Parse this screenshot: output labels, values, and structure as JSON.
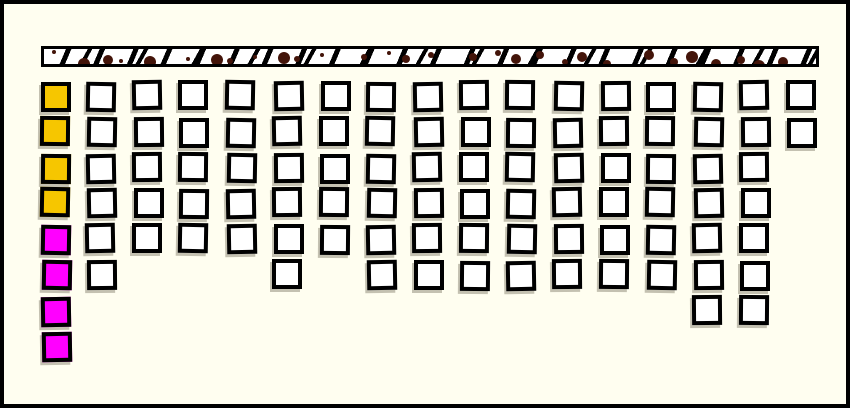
{
  "window": {
    "background_color": "#fffef0",
    "frame_color": "#000000"
  },
  "texture_bar": {
    "name": "hatched-header-bar",
    "fill_color": "#ffffff",
    "stripe_color": "#000000",
    "dot_color": "#431409",
    "border_color": "#000000"
  },
  "legend_colors": {
    "yellow": "#f6c600",
    "magenta": "#ff00ff",
    "white": "#ffffff",
    "outline": "#000000"
  },
  "grid": {
    "columns": 17,
    "total_colored_cells": 8,
    "total_white_cells": 90,
    "rows": [
      {
        "row": 1,
        "first_cell": "yellow",
        "white_cells": [
          2,
          3,
          4,
          5,
          6,
          7,
          8,
          9,
          10,
          11,
          12,
          13,
          14,
          15,
          16,
          17
        ]
      },
      {
        "row": 2,
        "first_cell": "yellow",
        "white_cells": [
          2,
          3,
          4,
          5,
          6,
          7,
          8,
          9,
          10,
          11,
          12,
          13,
          14,
          15,
          16,
          17
        ]
      },
      {
        "row": 3,
        "first_cell": "yellow",
        "white_cells": [
          2,
          3,
          4,
          5,
          6,
          7,
          8,
          9,
          10,
          11,
          12,
          13,
          14,
          15,
          16
        ]
      },
      {
        "row": 4,
        "first_cell": "yellow",
        "white_cells": [
          2,
          3,
          4,
          5,
          6,
          7,
          8,
          9,
          10,
          11,
          12,
          13,
          14,
          15,
          16
        ]
      },
      {
        "row": 5,
        "first_cell": "magenta",
        "white_cells": [
          2,
          3,
          4,
          5,
          6,
          7,
          8,
          9,
          10,
          11,
          12,
          13,
          14,
          15,
          16
        ]
      },
      {
        "row": 6,
        "first_cell": "magenta",
        "white_cells": [
          2,
          6,
          8,
          9,
          10,
          11,
          12,
          13,
          14,
          15,
          16
        ]
      },
      {
        "row": 7,
        "first_cell": "magenta",
        "white_cells": [
          15,
          16
        ]
      },
      {
        "row": 8,
        "first_cell": "magenta",
        "white_cells": []
      }
    ]
  }
}
